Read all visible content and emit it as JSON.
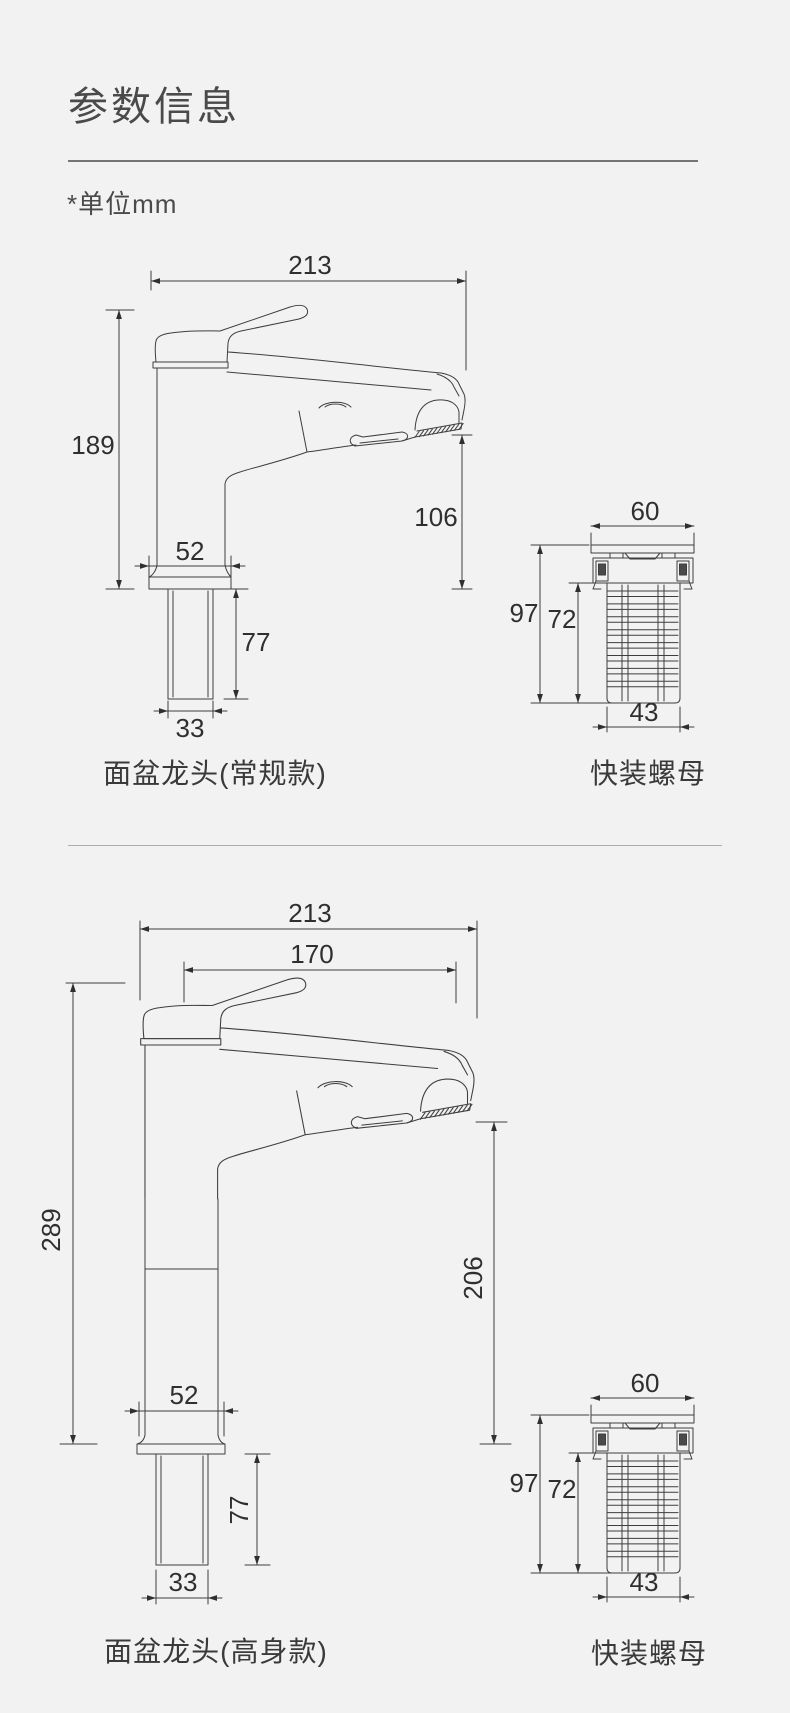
{
  "page": {
    "title": "参数信息",
    "unit_note": "*单位mm",
    "background_color": "#f2f2f2",
    "line_color": "#3e3e3e"
  },
  "sections": [
    {
      "faucet_label": "面盆龙头(常规款)",
      "nut_label": "快装螺母",
      "faucet_dims": {
        "total_width": "213",
        "total_height": "189",
        "spout_height": "106",
        "base_width": "52",
        "shank_length": "77",
        "shank_width": "33"
      },
      "nut_dims": {
        "top_width": "60",
        "total_height": "97",
        "body_height": "72",
        "body_width": "43"
      }
    },
    {
      "faucet_label": "面盆龙头(高身款)",
      "nut_label": "快装螺母",
      "faucet_dims": {
        "total_width": "213",
        "spout_reach": "170",
        "total_height": "289",
        "spout_height": "206",
        "base_width": "52",
        "shank_length": "77",
        "shank_width": "33"
      },
      "nut_dims": {
        "top_width": "60",
        "total_height": "97",
        "body_height": "72",
        "body_width": "43"
      }
    }
  ]
}
